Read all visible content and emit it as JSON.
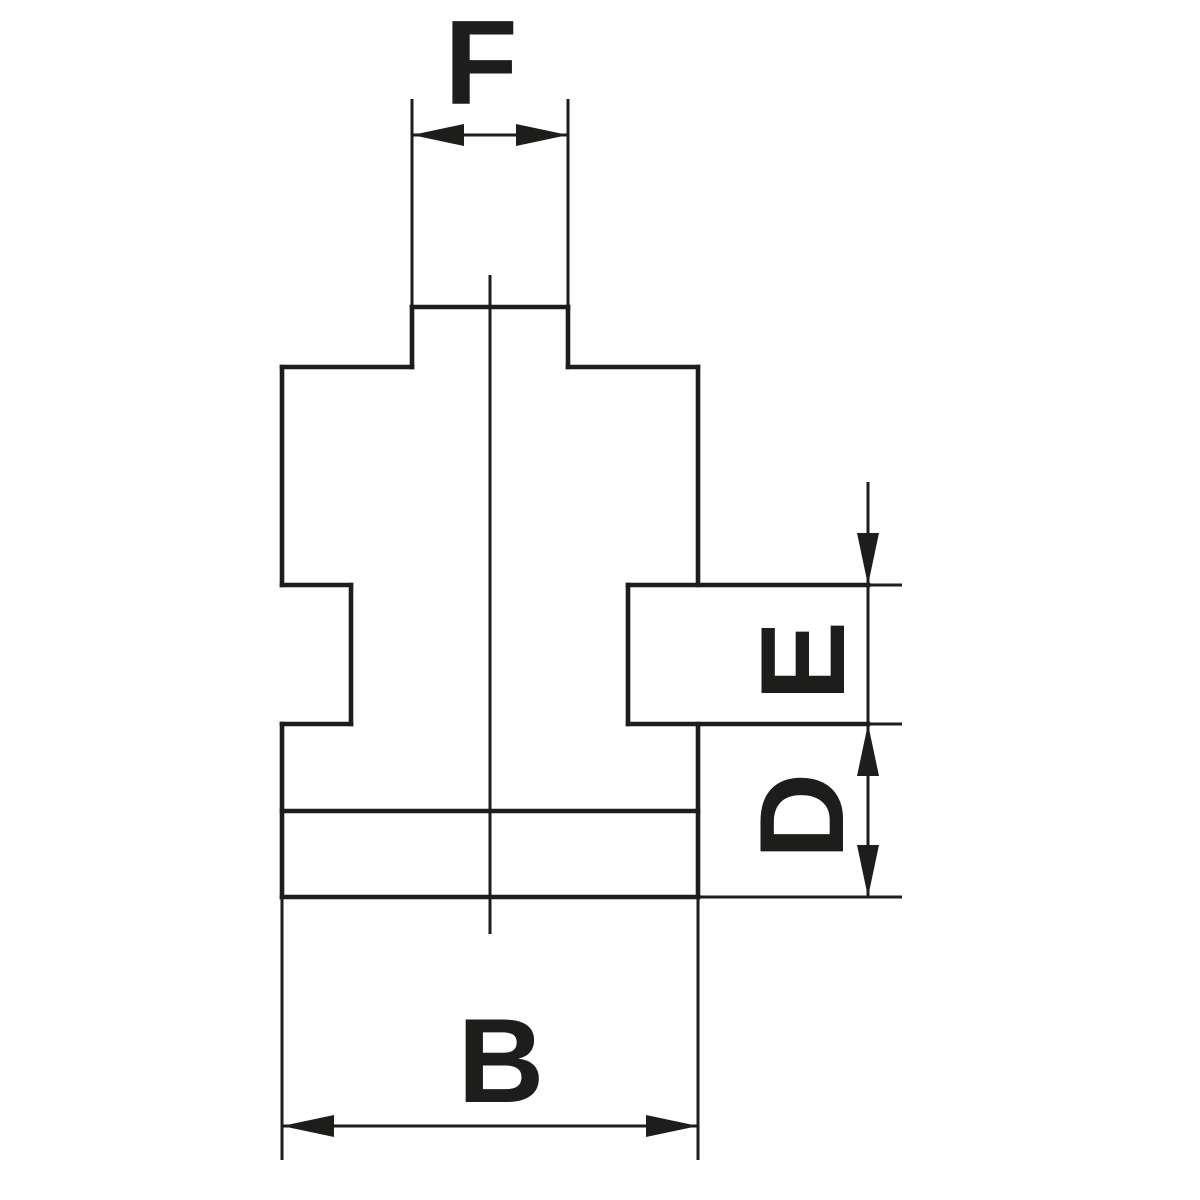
{
  "page": {
    "background_color": "#ffffff"
  },
  "diagram": {
    "type": "technical-drawing",
    "subject": "Cross-section of a stepped chuck-jaw blank with dimension callouts",
    "line_color": "#1d1d1b",
    "label_color": "#1d1d1b",
    "outline_stroke_width": 4.6,
    "thin_stroke_width": 3,
    "arrow_length": 52,
    "arrow_half_width": 11,
    "labels": [
      {
        "text": "F",
        "transform": "translate(481 61) rotate(0)"
      },
      {
        "text": "E",
        "transform": "translate(801 661) rotate(-90)"
      },
      {
        "text": "D",
        "transform": "translate(800 816) rotate(-90)"
      },
      {
        "text": "B",
        "transform": "translate(501 1059) rotate(0)"
      }
    ],
    "outline_lines": [
      [
        412,
        307,
        568,
        307
      ],
      [
        412,
        307,
        412,
        367
      ],
      [
        568,
        307,
        568,
        367
      ],
      [
        282,
        367,
        412,
        367
      ],
      [
        568,
        367,
        698,
        367
      ],
      [
        282,
        367,
        282,
        585
      ],
      [
        698,
        367,
        698,
        585
      ],
      [
        282,
        585,
        351,
        585
      ],
      [
        351,
        585,
        351,
        724
      ],
      [
        282,
        724,
        351,
        724
      ],
      [
        282,
        724,
        282,
        897
      ],
      [
        698,
        724,
        698,
        897
      ],
      [
        282,
        811,
        698,
        811
      ],
      [
        282,
        897,
        698,
        897
      ],
      [
        628,
        585,
        628,
        724
      ],
      [
        628,
        585,
        868,
        585
      ],
      [
        628,
        724,
        868,
        724
      ]
    ],
    "thin_lines": [
      [
        412,
        99,
        412,
        307
      ],
      [
        568,
        99,
        568,
        307
      ],
      [
        412,
        135,
        568,
        135
      ],
      [
        490,
        275,
        490,
        934
      ],
      [
        868,
        585,
        902,
        585
      ],
      [
        868,
        724,
        902,
        724
      ],
      [
        698,
        897,
        902,
        897
      ],
      [
        868,
        482,
        868,
        897
      ],
      [
        282,
        897,
        282,
        1160
      ],
      [
        698,
        897,
        698,
        1160
      ],
      [
        282,
        1126,
        698,
        1126
      ]
    ],
    "arrowheads": [
      {
        "tip": [
          412,
          135
        ],
        "direction": "left",
        "label": "f-left"
      },
      {
        "tip": [
          568,
          135
        ],
        "direction": "right",
        "label": "f-right"
      },
      {
        "tip": [
          868,
          585
        ],
        "direction": "down",
        "label": "e-top"
      },
      {
        "tip": [
          868,
          724
        ],
        "direction": "up",
        "label": "e-bottom-d-top"
      },
      {
        "tip": [
          868,
          897
        ],
        "direction": "down",
        "label": "d-bottom"
      },
      {
        "tip": [
          282,
          1126
        ],
        "direction": "left",
        "label": "b-left"
      },
      {
        "tip": [
          698,
          1126
        ],
        "direction": "right",
        "label": "b-right"
      }
    ]
  }
}
